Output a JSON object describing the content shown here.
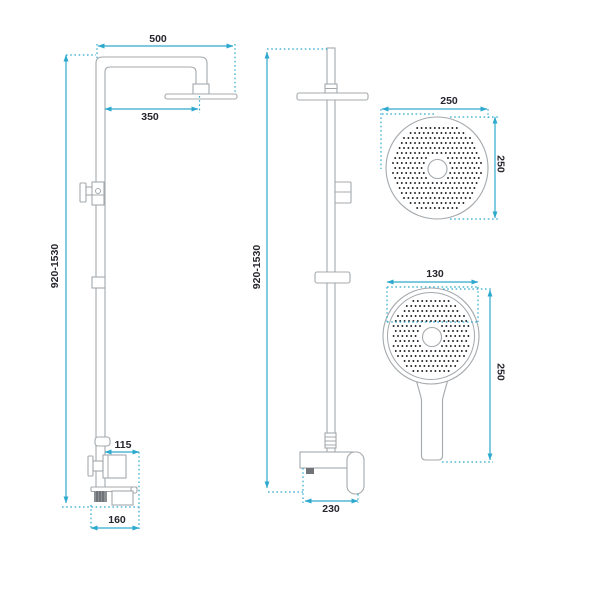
{
  "diagram_title": "shower-column-dimension-drawing",
  "colors": {
    "dimension_line": "#2ea9ce",
    "drawing_outline": "#a4a9ad",
    "label_text": "#26262e",
    "nozzle_dot": "#1f1f23"
  },
  "views": {
    "side": {
      "name": "side-view-shower-column",
      "dims": {
        "top_width": "500",
        "head_offset": "350",
        "height_range": "920-1530",
        "mixer_depth": "115",
        "base_width": "160"
      }
    },
    "front": {
      "name": "front-view-shower-column",
      "dims": {
        "height_range": "920-1530",
        "mixer_width": "230"
      }
    },
    "head_top": {
      "name": "overhead-shower-top-view",
      "dims": {
        "width": "250",
        "height": "250"
      }
    },
    "hand": {
      "name": "hand-shower-view",
      "dims": {
        "width": "130",
        "length": "250"
      }
    }
  }
}
